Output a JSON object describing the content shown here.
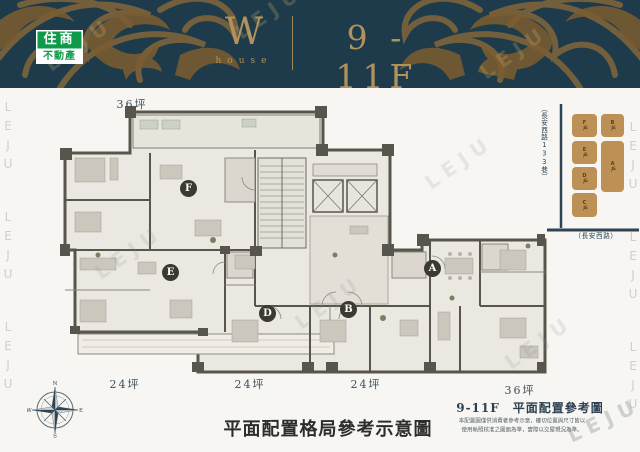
{
  "brand": {
    "logo_top": "住商",
    "logo_bottom": "不動產"
  },
  "header": {
    "letter": "W",
    "sub": "house",
    "floors": "9 - 11F"
  },
  "plan": {
    "area_top": "36坪",
    "area_bottom_1": "24坪",
    "area_bottom_2": "24坪",
    "area_bottom_3": "24坪",
    "area_bottom_4": "36坪",
    "units": {
      "f": "F",
      "e": "E",
      "d": "D",
      "b": "B",
      "a": "A"
    }
  },
  "keymap": {
    "lane": "（長安西路133巷）",
    "road": "（長安西路）",
    "boxes": [
      "F戶",
      "E戶",
      "D戶",
      "C戶",
      "B戶",
      "A戶"
    ]
  },
  "captions": {
    "ref_title": "9-11F　平面配置參考圖",
    "disclaimer1": "本配置圖僅供消費者參考示意，確切位置與尺寸皆以",
    "disclaimer2": "使用執照核准之圖面為準，實際以交屋現況為準。",
    "calligraphy": "平面配置格局參考示意圖"
  },
  "compass": {
    "n": "N",
    "e": "E",
    "s": "S",
    "w": "W"
  },
  "watermark": {
    "text": "LEJU"
  },
  "colors": {
    "header_bg": "#1d3b4a",
    "gold": "#b2925c",
    "ornament_gold": "#8a6839",
    "logo_green": "#0e9a48",
    "keymap_tan": "#bd9156",
    "wall": "#57554c",
    "plan_fill": "#ebe8e1",
    "navy_text": "#2e4455"
  }
}
